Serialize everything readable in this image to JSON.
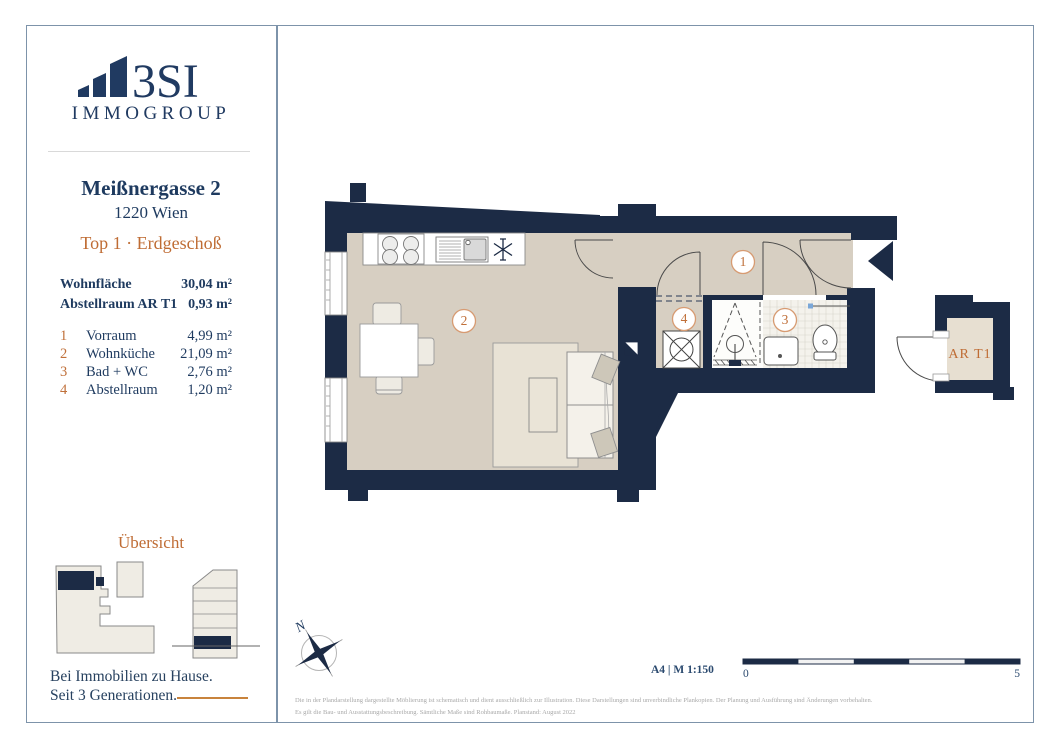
{
  "sidebar": {
    "logo": {
      "brand": "3SI",
      "sub": "IMMOGROUP"
    },
    "address_line1": "Meißnergasse 2",
    "address_line2": "1220 Wien",
    "unit_label": "Top 1 · Erdgeschoß",
    "areas": [
      {
        "label": "Wohnfläche",
        "value": "30,04 m²"
      },
      {
        "label": "Abstellraum AR T1",
        "value": "0,93 m²"
      }
    ],
    "rooms": [
      {
        "num": "1",
        "name": "Vorraum",
        "area": "4,99 m²"
      },
      {
        "num": "2",
        "name": "Wohnküche",
        "area": "21,09 m²"
      },
      {
        "num": "3",
        "name": "Bad + WC",
        "area": "2,76 m²"
      },
      {
        "num": "4",
        "name": "Abstellraum",
        "area": "1,20 m²"
      }
    ],
    "overview_title": "Übersicht",
    "tagline_line1": "Bei Immobilien zu Hause.",
    "tagline_line2": "Seit 3 Generationen."
  },
  "plan": {
    "room_labels": [
      "1",
      "2",
      "3",
      "4"
    ],
    "storage_label": "AR T1",
    "north_label": "N"
  },
  "footer": {
    "format_scale": "A4 | M 1:150",
    "scale_start": "0",
    "scale_end": "5",
    "disclaimer_line1": "Die in der Plandarstellung dargestellte Möblierung ist schematisch und dient ausschließlich zur Illustration. Diese Darstellungen sind unverbindliche Plankopien. Der Planung und Ausführung sind Änderungen vorbehalten.",
    "disclaimer_line2": "Es gilt die Bau- und Ausstattungsbeschreibung. Sämtliche Maße sind Rohbaumaße. Planstand: August 2022"
  },
  "colors": {
    "wall_navy": "#1c2b45",
    "floor_beige": "#d7cfc2",
    "accent_orange": "#bf6c34",
    "text_navy": "#1e3a5f",
    "border_blue": "#7d93aa"
  }
}
